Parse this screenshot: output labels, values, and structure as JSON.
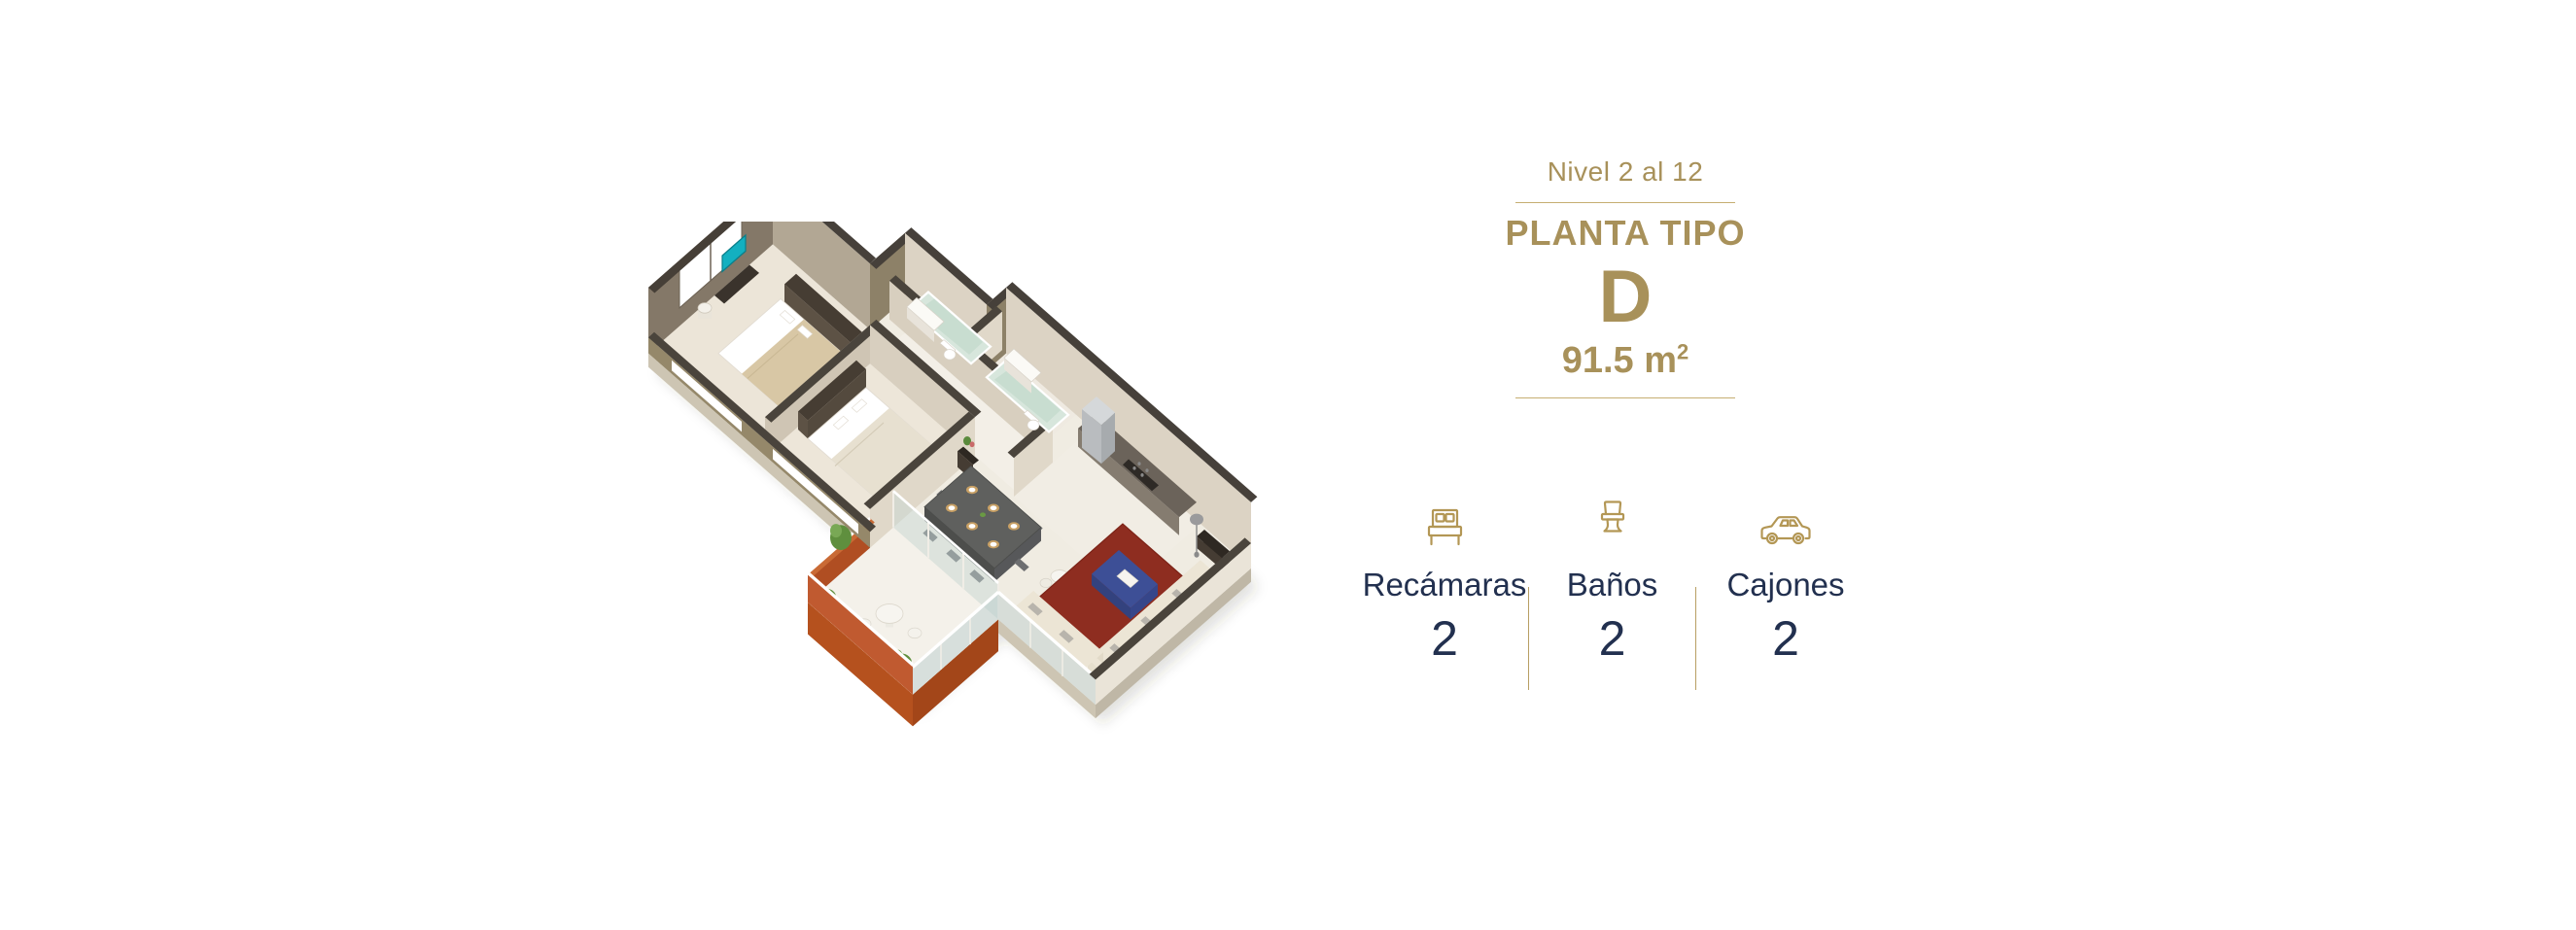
{
  "header": {
    "level": "Nivel 2 al 12",
    "type_label": "PLANTA TIPO",
    "letter": "D",
    "area_base": "91.5 m",
    "area_sup": "2"
  },
  "stats": {
    "items": [
      {
        "icon": "bed-icon",
        "label": "Recámaras",
        "value": "2"
      },
      {
        "icon": "toilet-icon",
        "label": "Baños",
        "value": "2"
      },
      {
        "icon": "car-icon",
        "label": "Cajones",
        "value": "2"
      }
    ]
  },
  "colors": {
    "accent_gold": "#a8915a",
    "divider_gold": "#c6ae72",
    "icon_gold": "#b39755",
    "text_navy": "#22304f",
    "plan_terracotta": "#c05a30",
    "plan_rug_red": "#8e2d20",
    "plan_wall_khaki": "#95886a",
    "plan_floor": "#f0ece2",
    "background": "#ffffff"
  }
}
